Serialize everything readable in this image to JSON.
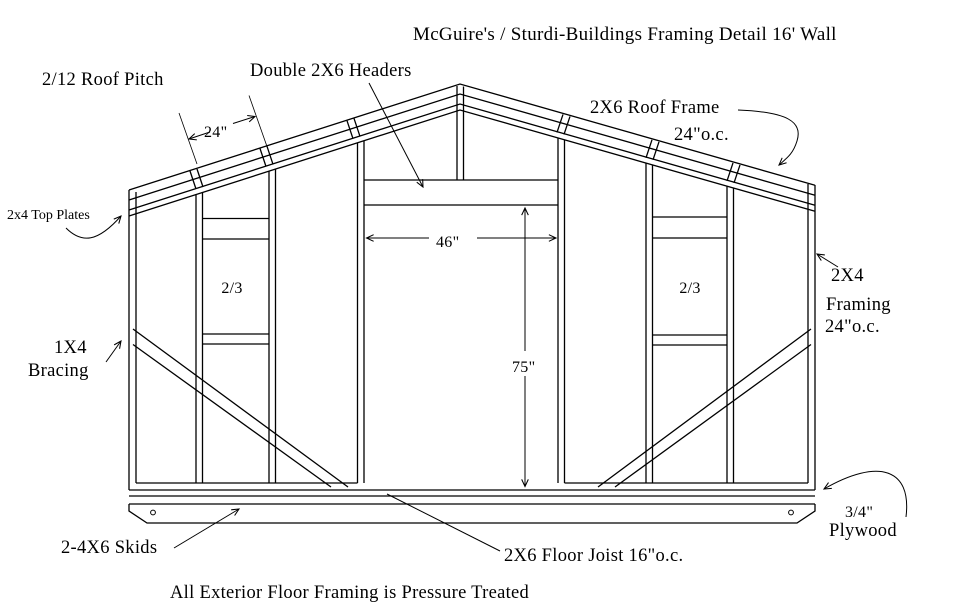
{
  "title": "McGuire's / Sturdi-Buildings Framing Detail 16' Wall",
  "labels": {
    "roof_pitch": "2/12 Roof Pitch",
    "headers": "Double 2X6 Headers",
    "roof_frame_line1": "2X6 Roof Frame",
    "roof_frame_line2": "24\"o.c.",
    "top_plates": "2x4 Top Plates",
    "framing_line1": "2X4",
    "framing_line2": "Framing",
    "framing_line3": "24\"o.c.",
    "bracing_line1": "1X4",
    "bracing_line2": "Bracing",
    "skids": "2-4X6 Skids",
    "floor_joist": "2X6 Floor Joist 16\"o.c.",
    "plywood_line1": "3/4\"",
    "plywood_line2": "Plywood",
    "footnote": "All Exterior Floor Framing is Pressure Treated"
  },
  "dimensions": {
    "rafter_spacing": "24\"",
    "door_width": "46\"",
    "door_height": "75\"",
    "left_bay_label": "2/3",
    "right_bay_label": "2/3"
  }
}
